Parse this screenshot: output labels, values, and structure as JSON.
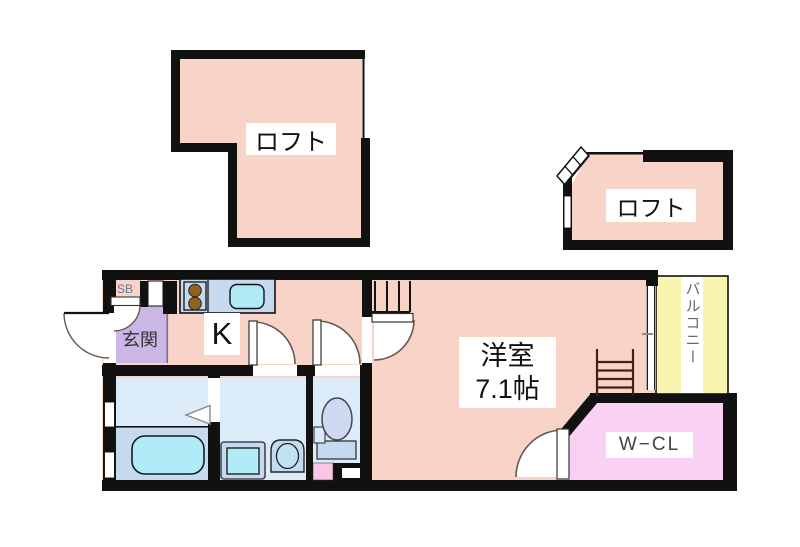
{
  "title": "間取り図 (floor plan)",
  "rooms": {
    "loft_upper_left": {
      "label": "ロフト"
    },
    "loft_upper_right": {
      "label": "ロフト"
    },
    "kitchen": {
      "label": "K"
    },
    "entrance": {
      "label": "玄関"
    },
    "shoe_box": {
      "label": "SB"
    },
    "western_room": {
      "label_line1": "洋室",
      "label_line2": "7.1帖",
      "size_tatami": 7.1
    },
    "walk_in_closet": {
      "label": "W−CL"
    },
    "balcony": {
      "label": "バルコニー"
    }
  },
  "fixtures": [
    "kitchen-counter",
    "stove-two-burners",
    "kitchen-sink",
    "bathtub",
    "washing-machine",
    "vanity-sink",
    "toilet",
    "loft-stairs",
    "loft-ladder",
    "diagonal-loft-ladder",
    "door-swings",
    "windows"
  ],
  "colors": {
    "wall": "#111111",
    "room_pink": "#f8d4c8",
    "entrance_lavender": "#cbb6e6",
    "shoe_box_pink": "#f4c4e6",
    "wet_room_blue": "#dcebf8",
    "fixture_blue": "#c5daee",
    "water_cyan": "#b0ebf8",
    "balcony_yellow": "#f8f5b0",
    "closet_pink": "#f9d2f3"
  }
}
